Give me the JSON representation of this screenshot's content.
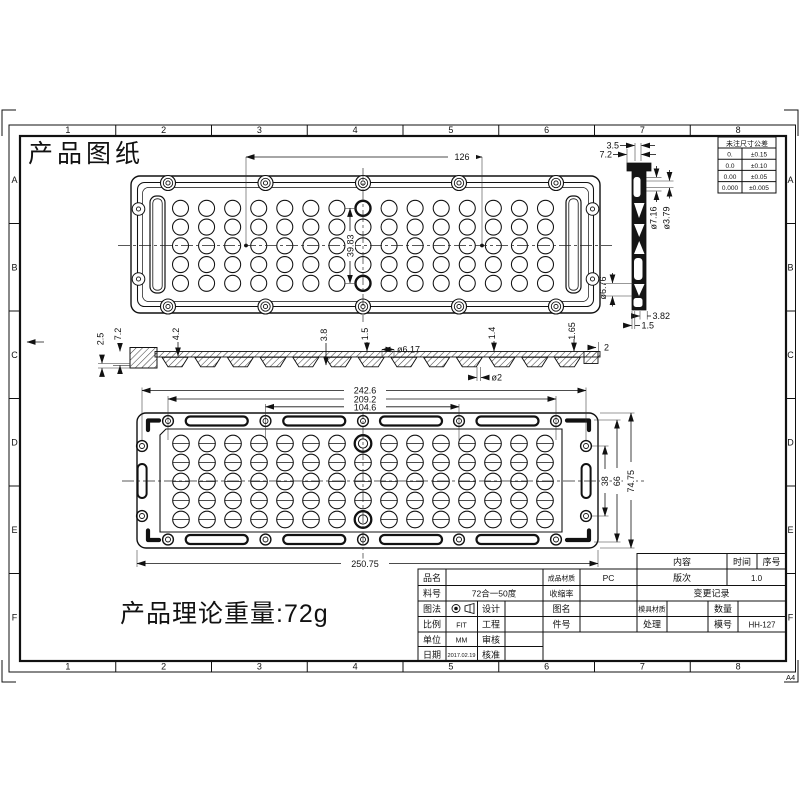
{
  "sheet": {
    "title": "产品图纸",
    "weight_note": "产品理论重量:72g",
    "paper": "A4"
  },
  "border": {
    "cols": [
      "1",
      "2",
      "3",
      "4",
      "5",
      "6",
      "7",
      "8"
    ],
    "rows": [
      "A",
      "B",
      "C",
      "D",
      "E",
      "F"
    ]
  },
  "tol": {
    "title": "未注尺寸公差",
    "rows": [
      {
        "p": "0.",
        "t": "±0.15"
      },
      {
        "p": "0.0",
        "t": "±0.10"
      },
      {
        "p": "0.00",
        "t": "±0.05"
      },
      {
        "p": "0.000",
        "t": "±0.005"
      }
    ]
  },
  "dims": {
    "top": {
      "width": "126",
      "pitch": "39.83"
    },
    "side": {
      "d1": "2.5",
      "d2": "7.2",
      "d3": "4.2",
      "d4": "3.8",
      "d5": "1.5",
      "d6": "ø6.17",
      "d7": "1.4",
      "d8": "1.65",
      "d9": "2",
      "d10": "ø2"
    },
    "end": {
      "d1": "3.5",
      "d2": "7.2",
      "d3": "ø7.16",
      "d4": "ø3.79",
      "d5": "ø6.76",
      "d6": "3.82",
      "d7": "1.5"
    },
    "bottom": {
      "d1": "242.6",
      "d2": "209.2",
      "d3": "104.6",
      "d4": "250.75",
      "d5": "38",
      "d6": "66",
      "d7": "74.75"
    }
  },
  "title_block": {
    "product_name_label": "品名",
    "product_name": "",
    "material_label": "成品材质",
    "material": "PC",
    "version_label": "版次",
    "version": "1.0",
    "content_label": "内容",
    "time_label": "时间",
    "serial_label": "序号",
    "part_no_label": "料号",
    "part_no": "72合一50度",
    "shrinkage_label": "收缩率",
    "change_record_label": "变更记录",
    "projection_label": "图法",
    "design_label": "设计",
    "drawing_name_label": "图名",
    "mold_material_label": "模具材质",
    "quantity_label": "数量",
    "scale_label": "比例",
    "scale": "FIT",
    "engineering_label": "工程",
    "item_no_label": "件号",
    "treatment_label": "处理",
    "mold_no_label": "模号",
    "mold_no": "HH-127",
    "unit_label": "单位",
    "unit": "MM",
    "review_label": "审核",
    "date_label": "日期",
    "date": "2017.02.19",
    "approve_label": "核准"
  }
}
